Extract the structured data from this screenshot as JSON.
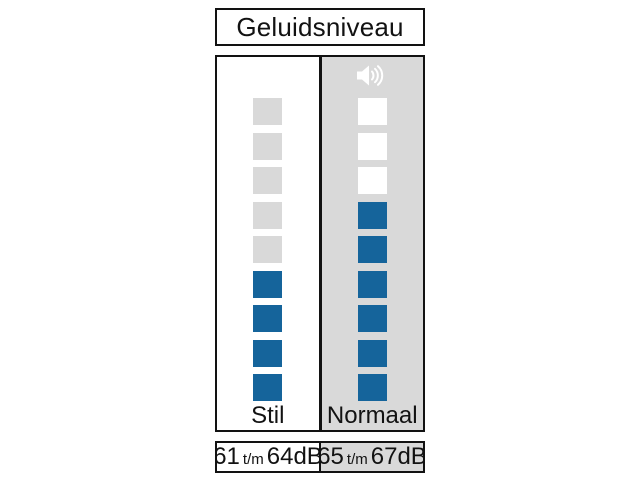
{
  "title": "Geluidsniveau",
  "colors": {
    "filled_blue": "#15649b",
    "light_gray": "#d9d9d9",
    "border_black": "#121212",
    "white": "#ffffff",
    "speaker_icon": "#ffffff"
  },
  "meter": {
    "rows": 9,
    "columns": [
      {
        "id": "stil",
        "label": "Stil",
        "background": "#ffffff",
        "empty_color": "#d9d9d9",
        "filled": 4,
        "has_speaker_icon": false,
        "range": {
          "low": "61",
          "sep": "t/m",
          "high": "64",
          "unit": "dB"
        }
      },
      {
        "id": "normaal",
        "label": "Normaal",
        "background": "#d9d9d9",
        "empty_color": "#ffffff",
        "filled": 6,
        "has_speaker_icon": true,
        "range": {
          "low": "65",
          "sep": "t/m",
          "high": "67",
          "unit": "dB"
        }
      }
    ]
  },
  "icons": {
    "speaker": "speaker-volume-icon"
  },
  "chart_data": {
    "type": "bar",
    "title": "Geluidsniveau",
    "categories": [
      "Stil",
      "Normaal"
    ],
    "series": [
      {
        "name": "gevulde segmenten (van 9)",
        "values": [
          4,
          6
        ]
      }
    ],
    "annotations": [
      "61 t/m 64dB",
      "65 t/m 67dB"
    ],
    "ylim": [
      0,
      9
    ],
    "legend": "none",
    "grid": false
  }
}
